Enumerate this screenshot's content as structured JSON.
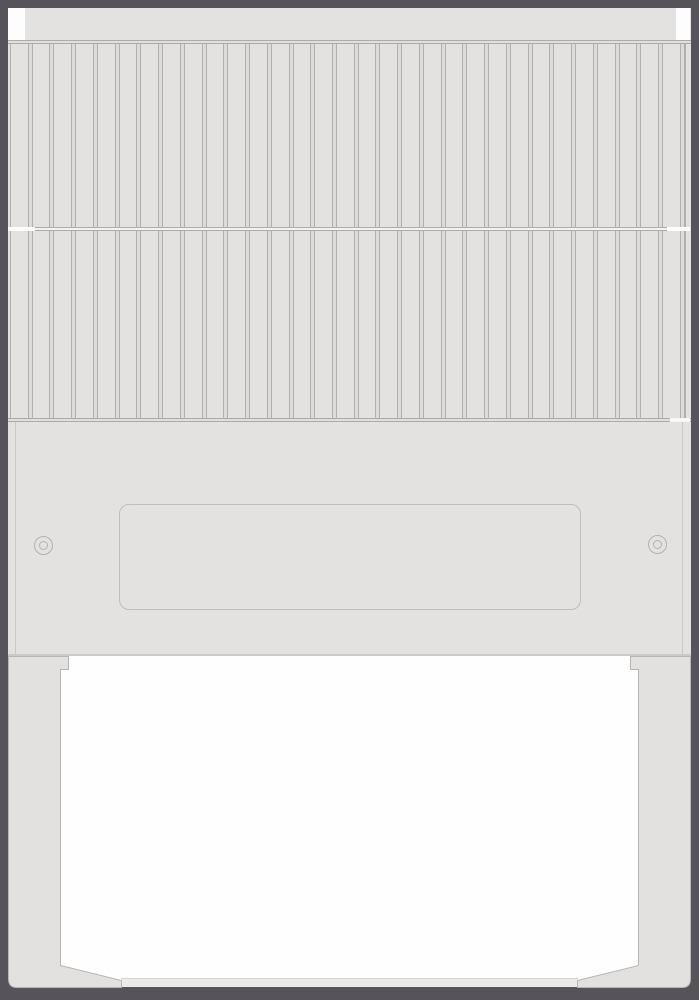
{
  "diagram": {
    "type": "technical-illustration",
    "subject": "appliance rear view line drawing: finned grille, blank service panel with two screws and empty nameplate recess, open base compartment between two legs",
    "labels": [],
    "nameplate_text": "",
    "grille": {
      "rows": 2,
      "slats_per_row": 31,
      "upper_row_height_px": 183,
      "lower_row_height_px": 187
    },
    "screws": {
      "count": 2
    },
    "colors": {
      "frame": "#56535A",
      "body": "#E3E2E0",
      "line": "#B1B0AE",
      "rib_fill": "#DCDBD9",
      "seam_line": "#ABABA9",
      "seam_gap": "#E0DFDD",
      "rail_gap": "#F2F2F0",
      "white_hi": "#FDFDFD",
      "white": "#FEFEFE",
      "fold": "#C9C8C6",
      "plate_border": "#BFBEBC",
      "screw_border": "#B3B2B0",
      "panel_edge": "#CBCAC8",
      "base_rail": "#EBEAE8",
      "base_rail_edge": "#D6D5D3",
      "leg_fill": "#E2E1DF",
      "leg_stroke": "#B7B6B4"
    }
  }
}
